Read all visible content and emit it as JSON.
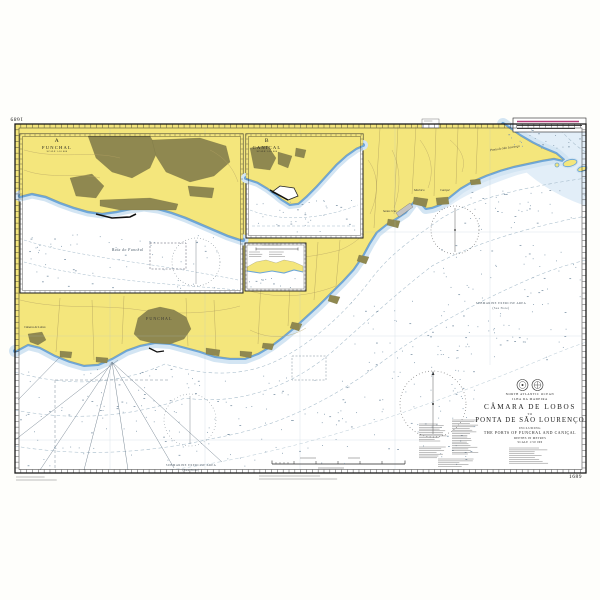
{
  "chart_number": "1689",
  "title_block": {
    "region_line1": "NORTH ATLANTIC OCEAN",
    "region_line2": "ILHA DA MADEIRA",
    "title_line1": "CÂMARA DE LOBOS",
    "title_connector": "TO",
    "title_line2": "PONTA DE SÃO LOURENÇO",
    "including": "INCLUDING",
    "subtitle": "THE PORTS OF FUNCHAL AND CANIÇAL",
    "depths_note": "DEPTHS IN METRES",
    "scale_note": "SCALE 1:50 000"
  },
  "insets": {
    "funchal": {
      "letter": "A",
      "name": "FUNCHAL",
      "scale": "SCALE 1:10 000"
    },
    "canical": {
      "letter": "B",
      "name": "CANIÇAL",
      "scale": "SCALE 1:10 000"
    }
  },
  "sea_labels": {
    "funchal_bay": "Baía do Funchal",
    "submarine_area_east": {
      "line1": "SUBMARINE EXERCISE AREA",
      "line2": "(See Note)"
    },
    "submarine_area_south": {
      "line1": "SUBMARINE EXERCISE AREA",
      "line2": "(See Note)"
    }
  },
  "place_labels": {
    "camara_de_lobos": "Câmara de Lobos",
    "funchal_city": "FUNCHAL",
    "santa_cruz": "Santa Cruz",
    "machico": "Machico",
    "canical": "Caniçal",
    "ponta_sao_lourenco": "Ponta de São Lourenço"
  },
  "corner_numbers": {
    "top_left": "1689",
    "bottom_right": "1689"
  },
  "colors": {
    "land_yellow": "#f4e67c",
    "built_up_olive": "#8f8850",
    "coast_blue": "#6ea7d8",
    "shallow_blue": "#d3e5f3",
    "magenta_note": "#b53a78"
  }
}
